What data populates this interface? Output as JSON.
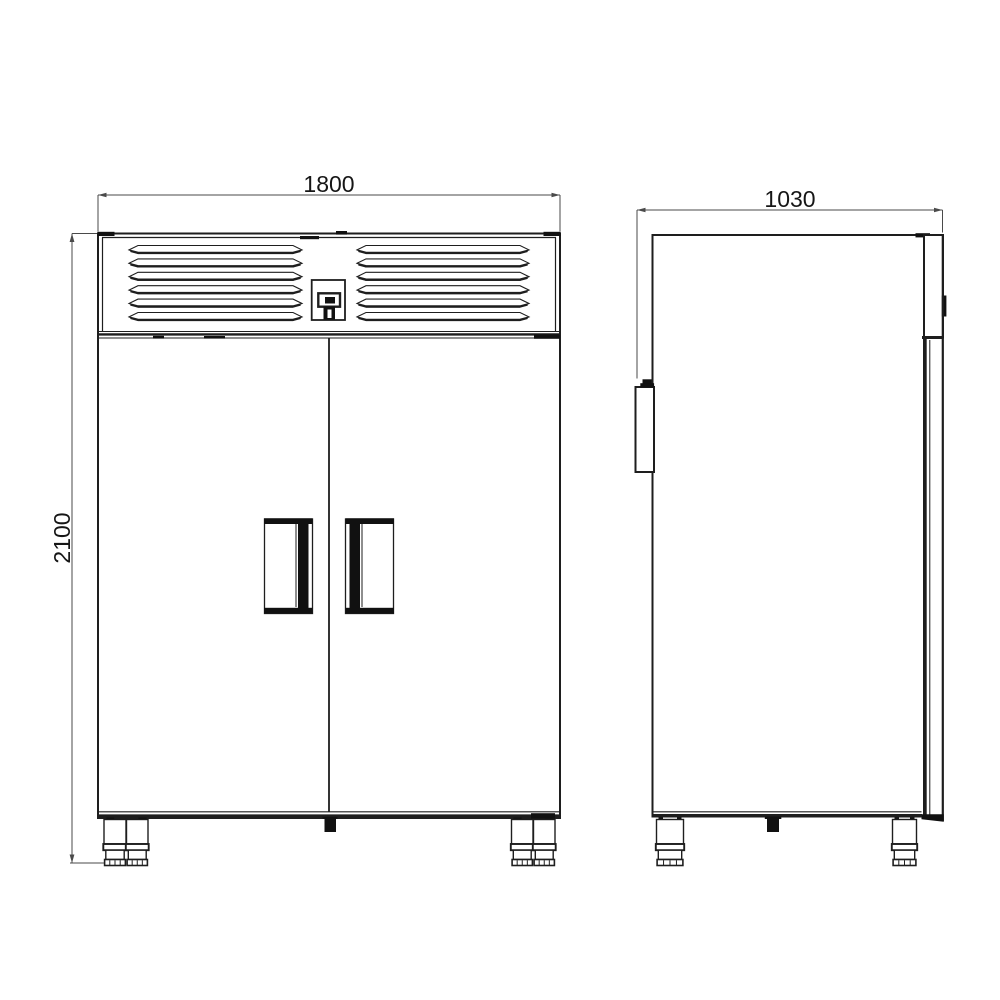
{
  "dimensions": {
    "front_width": "1800",
    "front_height": "2100",
    "side_depth": "1030"
  },
  "colors": {
    "line": "#1e1e1e",
    "dim_line": "#4a4a4a",
    "fill_dark": "#111111",
    "background": "#ffffff"
  }
}
